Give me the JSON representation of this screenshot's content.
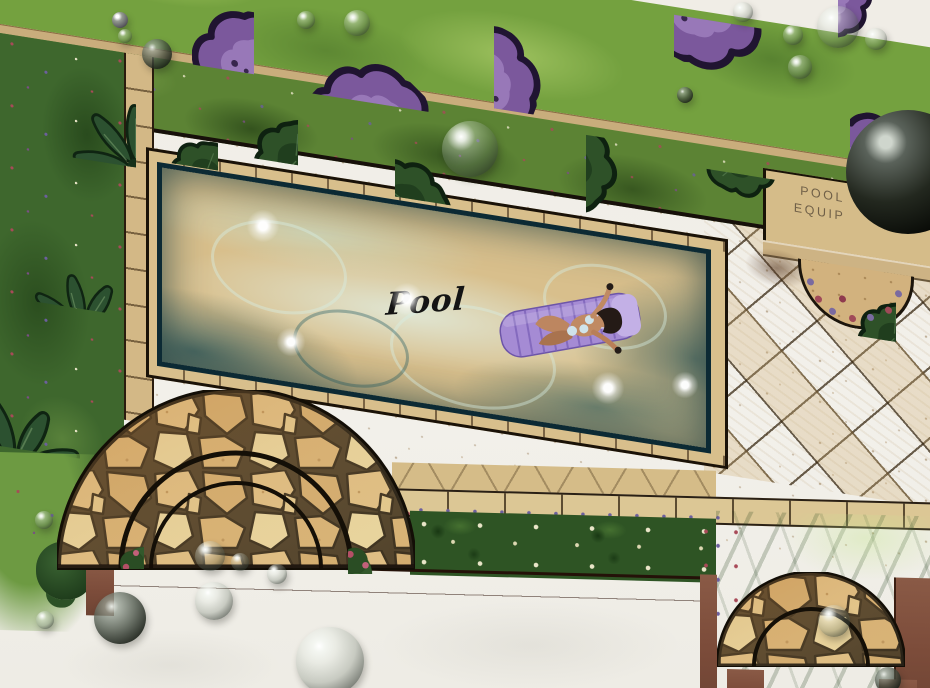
{
  "labels": {
    "pool": "Pool",
    "equip_line1": "POOL",
    "equip_line2": "EQUIP"
  },
  "palette": {
    "paper": "#f0ede6",
    "lawn": "#74a13f",
    "hedge": "#5c8334",
    "bed_green": "#3e672d",
    "tree_purple": "#7b589c",
    "tree_purple_light": "#a283c2",
    "water": "#2f8e99",
    "water_deep": "#15576b",
    "deck": "#d8bf8c",
    "patio": "#e6d9a8",
    "coping_line": "#1a1208",
    "stone": "#d8b377",
    "stone_gap": "#42331d",
    "wall": "#7c4c3a",
    "flower_red": "#a84a58",
    "flower_purple": "#6c5f9e",
    "flower_cream": "#e9e5c8",
    "float_lavender": "#a58bd4",
    "skin": "#c08a63",
    "ink": "#141414"
  },
  "scene": {
    "type": "hand-rendered landscape plan",
    "features": [
      "swimming pool with sunbather on float",
      "pool deck and coping",
      "diagonal tile patio",
      "pool equipment pad",
      "purple canopy tree row on lawn",
      "hedge band with dark shrubs",
      "tropical planting beds with palms",
      "flagstone semicircle terrace",
      "small flagstone semicircle landing",
      "flower beds and rose bushes",
      "brown garden walls",
      "glass water droplets on paper"
    ]
  }
}
